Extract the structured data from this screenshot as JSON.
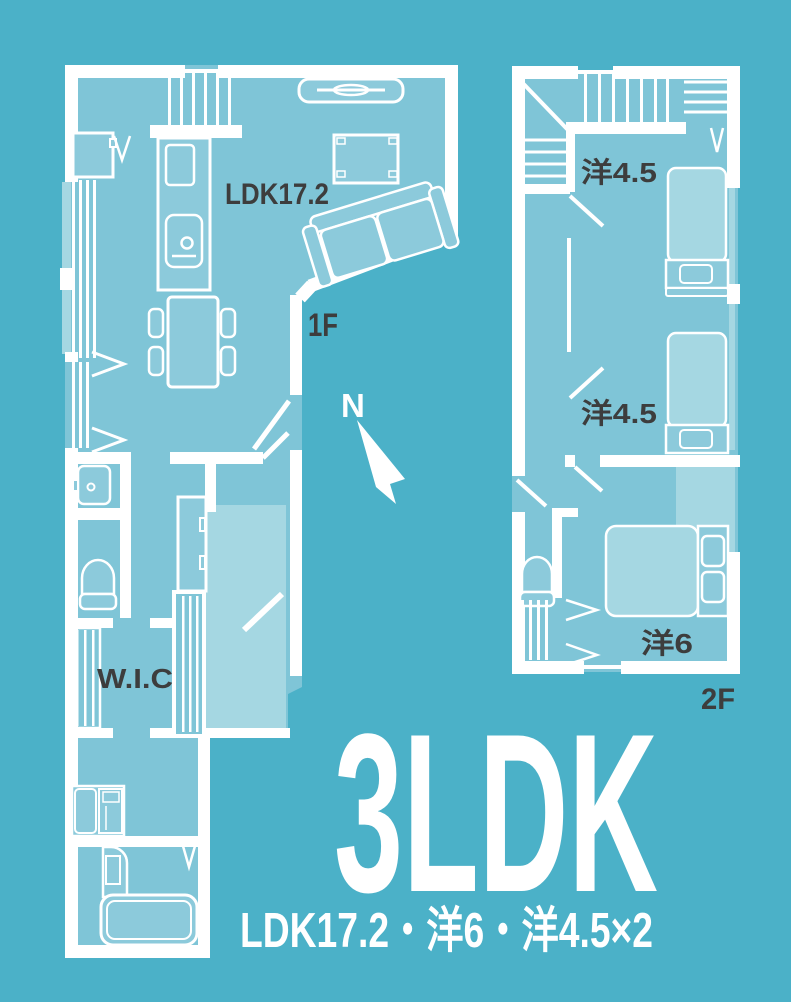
{
  "poster": {
    "type": "floor-plan",
    "colors": {
      "background": "#4bb1c8",
      "floor_fill": "#7fc5d7",
      "furniture_fill": "#8ccadb",
      "light_area_fill": "#a5d7e2",
      "line": "#ffffff",
      "label_dark": "#3d3d3d",
      "label_light": "#ffffff"
    }
  },
  "floor1": {
    "floor_label": "1F",
    "room_label": "LDK17.2",
    "wic_label": "W.I.C",
    "compass_label": "N"
  },
  "floor2": {
    "floor_label": "2F",
    "rooms": [
      {
        "label": "洋4.5"
      },
      {
        "label": "洋4.5"
      },
      {
        "label": "洋6"
      }
    ]
  },
  "summary": {
    "title": "3LDK",
    "subtitle": "LDK17.2・洋6・洋4.5×2"
  }
}
